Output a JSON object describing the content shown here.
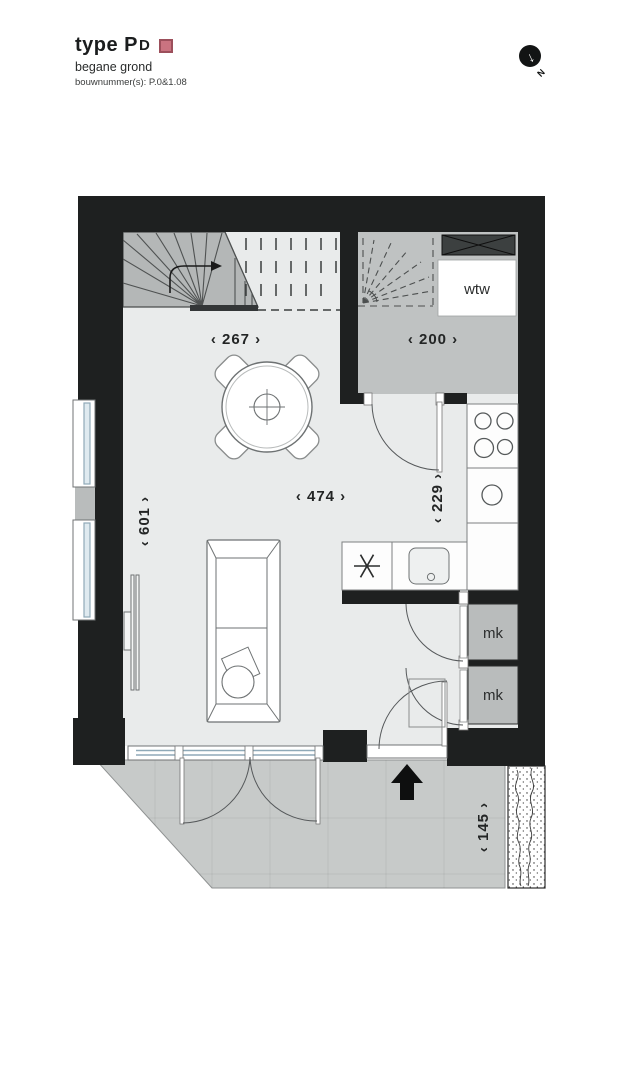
{
  "header": {
    "title_prefix": "type P",
    "title_small": "D",
    "subtitle": "begane grond",
    "bouwnummer": "bouwnummer(s): P.0&1.08"
  },
  "compass": {
    "north_label": "N",
    "arrow_glyph": "↓"
  },
  "plan": {
    "labels": {
      "wtw": "wtw",
      "mk_top": "mk",
      "mk_bottom": "mk"
    },
    "dimensions": {
      "stair_width": "‹ 267 ›",
      "hall_width": "‹ 200 ›",
      "living_width": "‹ 474 ›",
      "kitchen_depth": "‹ 229 ›",
      "living_depth": "‹ 601 ›",
      "side_strip": "‹ 145 ›"
    }
  },
  "colors": {
    "wall": "#1e2020",
    "floor": "#e9ebeb",
    "hall_floor": "#bfc2c2",
    "stair": "#b4b7b7",
    "terrace": "#c7cac9",
    "closet": "#b9bcbc",
    "glass": "#8fa9b8",
    "shaft": "#3c4040",
    "accent": "#ca7380"
  }
}
